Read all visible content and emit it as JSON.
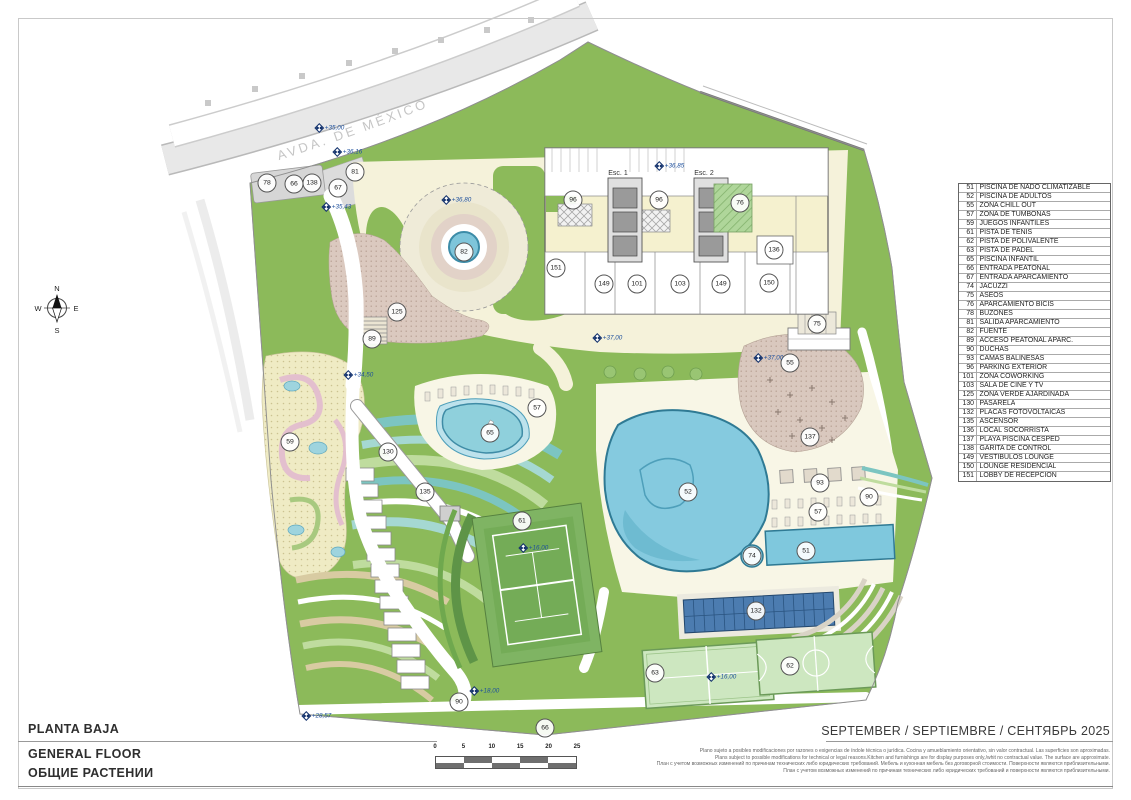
{
  "sheet": {
    "title_es": "PLANTA BAJA",
    "title_en": "GENERAL FLOOR",
    "title_ru": "ОБЩИЕ РАСТЕНИИ",
    "date_line": "SEPTEMBER / SEPTIEMBRE / СЕНТЯБРЬ 2025"
  },
  "street_label": "AVDA. DE MÉXICO",
  "compass": {
    "n": "N",
    "s": "S",
    "e": "E",
    "w": "W"
  },
  "building": {
    "esc1": "Esc. 1",
    "esc2": "Esc. 2"
  },
  "scale_bar": {
    "ticks": [
      "0",
      "5",
      "10",
      "15",
      "20",
      "25"
    ]
  },
  "disclaimer": {
    "es": "Plano sujeto a posibles modificaciones por razones o exigencias de índole técnica o jurídica. Cocina y amueblamiento orientativo, sin valor contractual. Las superficies son aproximadas.",
    "en": "Plans subject to possible modifications for technical or legal reasons.Kitchen and furnishings are for display purposes only,/whit no contractual value. The surface are approximate.",
    "ru1": "План с учетом возможных изменений по причинам технических либо юридических требований. Мебель и кухонная мебель без договорной стоимости. Поверхности являются приблизительными.",
    "ru2": "План с учетом возможных изменений по причинам технических либо юридических требований и поверхности являются приблизительными."
  },
  "legend": {
    "items": [
      {
        "num": "51",
        "label": "PISCINA DE NADO CLIMATIZABLE"
      },
      {
        "num": "52",
        "label": "PISCINA DE ADULTOS"
      },
      {
        "num": "55",
        "label": "ZONA CHILL OUT"
      },
      {
        "num": "57",
        "label": "ZONA DE TUMBONAS"
      },
      {
        "num": "59",
        "label": "JUEGOS INFANTILES"
      },
      {
        "num": "61",
        "label": "PISTA DE TENIS"
      },
      {
        "num": "62",
        "label": "PISTA DE POLIVALENTE"
      },
      {
        "num": "63",
        "label": "PISTA DE PADEL"
      },
      {
        "num": "65",
        "label": "PISCINA INFANTIL"
      },
      {
        "num": "66",
        "label": "ENTRADA PEATONAL"
      },
      {
        "num": "67",
        "label": "ENTRADA APARCAMIENTO"
      },
      {
        "num": "74",
        "label": "JACUZZI"
      },
      {
        "num": "75",
        "label": "ASEOS"
      },
      {
        "num": "76",
        "label": "APARCAMIENTO BICIS"
      },
      {
        "num": "78",
        "label": "BUZONES"
      },
      {
        "num": "81",
        "label": "SALIDA APARCAMIENTO"
      },
      {
        "num": "82",
        "label": "FUENTE"
      },
      {
        "num": "89",
        "label": "ACCESO PEATONAL APARC."
      },
      {
        "num": "90",
        "label": "DUCHAS"
      },
      {
        "num": "93",
        "label": "CAMAS BALINESAS"
      },
      {
        "num": "96",
        "label": "PARKING EXTERIOR"
      },
      {
        "num": "101",
        "label": "ZONA COWORKING"
      },
      {
        "num": "103",
        "label": "SALA DE CINE Y TV"
      },
      {
        "num": "125",
        "label": "ZONA VERDE AJARDINADA"
      },
      {
        "num": "130",
        "label": "PASARELA"
      },
      {
        "num": "132",
        "label": "PLACAS FOTOVOLTAICAS"
      },
      {
        "num": "135",
        "label": "ASCENSOR"
      },
      {
        "num": "136",
        "label": "LOCAL SOCORRISTA"
      },
      {
        "num": "137",
        "label": "PLAYA PISCINA CESPED"
      },
      {
        "num": "138",
        "label": "GARITA DE CONTROL"
      },
      {
        "num": "149",
        "label": "VESTÍBULOS LOUNGE"
      },
      {
        "num": "150",
        "label": "LOUNGE RESIDENCIAL"
      },
      {
        "num": "151",
        "label": "LOBBY DE RECEPCIÓN"
      }
    ]
  },
  "plan": {
    "circle_markers": [
      {
        "n": "78",
        "x": 267,
        "y": 183
      },
      {
        "n": "66",
        "x": 294,
        "y": 184
      },
      {
        "n": "138",
        "x": 312,
        "y": 183
      },
      {
        "n": "67",
        "x": 338,
        "y": 188
      },
      {
        "n": "81",
        "x": 355,
        "y": 172
      },
      {
        "n": "96",
        "x": 573,
        "y": 200
      },
      {
        "n": "96",
        "x": 659,
        "y": 200
      },
      {
        "n": "76",
        "x": 740,
        "y": 203
      },
      {
        "n": "136",
        "x": 774,
        "y": 250
      },
      {
        "n": "151",
        "x": 556,
        "y": 268
      },
      {
        "n": "149",
        "x": 604,
        "y": 284
      },
      {
        "n": "101",
        "x": 637,
        "y": 284
      },
      {
        "n": "103",
        "x": 680,
        "y": 284
      },
      {
        "n": "149",
        "x": 721,
        "y": 284
      },
      {
        "n": "150",
        "x": 769,
        "y": 283
      },
      {
        "n": "75",
        "x": 817,
        "y": 324
      },
      {
        "n": "55",
        "x": 790,
        "y": 363
      },
      {
        "n": "125",
        "x": 397,
        "y": 312
      },
      {
        "n": "89",
        "x": 372,
        "y": 339
      },
      {
        "n": "59",
        "x": 290,
        "y": 442
      },
      {
        "n": "130",
        "x": 388,
        "y": 452
      },
      {
        "n": "135",
        "x": 425,
        "y": 492
      },
      {
        "n": "57",
        "x": 537,
        "y": 408
      },
      {
        "n": "65",
        "x": 490,
        "y": 433
      },
      {
        "n": "61",
        "x": 522,
        "y": 521
      },
      {
        "n": "52",
        "x": 688,
        "y": 492
      },
      {
        "n": "74",
        "x": 752,
        "y": 556
      },
      {
        "n": "51",
        "x": 806,
        "y": 551
      },
      {
        "n": "93",
        "x": 820,
        "y": 483
      },
      {
        "n": "90",
        "x": 869,
        "y": 497
      },
      {
        "n": "57",
        "x": 818,
        "y": 512
      },
      {
        "n": "137",
        "x": 810,
        "y": 437
      },
      {
        "n": "132",
        "x": 756,
        "y": 611
      },
      {
        "n": "63",
        "x": 655,
        "y": 673
      },
      {
        "n": "62",
        "x": 790,
        "y": 666
      },
      {
        "n": "90",
        "x": 459,
        "y": 702
      },
      {
        "n": "66",
        "x": 545,
        "y": 728
      },
      {
        "n": "82",
        "x": 464,
        "y": 252
      }
    ],
    "level_markers": [
      {
        "t": "+35,00",
        "x": 330,
        "y": 128
      },
      {
        "t": "+36,16",
        "x": 348,
        "y": 152
      },
      {
        "t": "+35,43",
        "x": 337,
        "y": 207
      },
      {
        "t": "+36,80",
        "x": 457,
        "y": 200
      },
      {
        "t": "+36,85",
        "x": 670,
        "y": 166
      },
      {
        "t": "+37,00",
        "x": 608,
        "y": 338
      },
      {
        "t": "+37,00",
        "x": 769,
        "y": 358
      },
      {
        "t": "+34,50",
        "x": 359,
        "y": 375
      },
      {
        "t": "+16,00",
        "x": 534,
        "y": 548
      },
      {
        "t": "+16,00",
        "x": 722,
        "y": 677
      },
      {
        "t": "+18,00",
        "x": 485,
        "y": 691
      },
      {
        "t": "+28,57",
        "x": 317,
        "y": 716
      }
    ]
  },
  "colors": {
    "lawn": "#8CBA5A",
    "teal": "#7CC5C1",
    "pool": "#7FC8DD",
    "pool_edge": "#2F7A94",
    "path_cream": "#F5F2DA",
    "plaza_pink": "#DBC9BF",
    "pv_blue": "#4C7CB0",
    "court_green": "#CDE7C0",
    "road_gray": "#E8E8E8",
    "level_blue": "#1d4f9c"
  }
}
